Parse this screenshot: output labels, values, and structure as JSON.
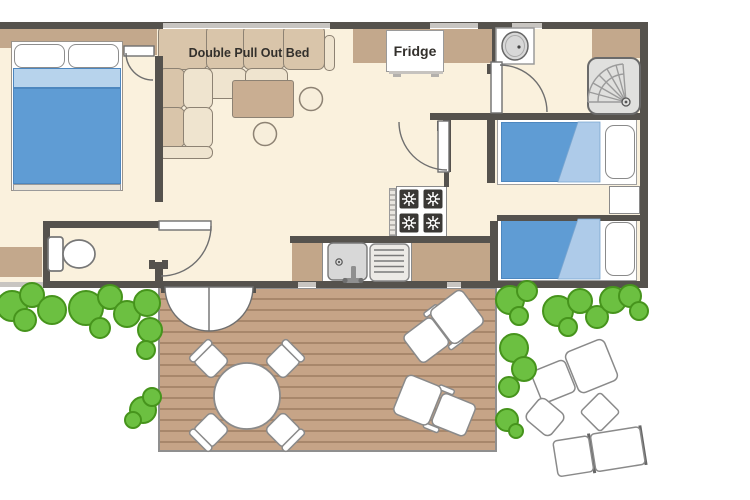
{
  "plan": {
    "labels": {
      "sofa_bed": "Double Pull Out Bed",
      "fridge": "Fridge"
    }
  },
  "colors": {
    "background": "#ffffff",
    "floor": "#faf1dd",
    "wall": "#55524d",
    "window": "#c8c5c1",
    "cabinet_tan": "#c3a88c",
    "counter_tan": "#c2a689",
    "deck_wood": "#c6a487",
    "deck_line": "#a8876b",
    "sofa_back": "#d9c5aa",
    "sofa_seat": "#efe4cf",
    "furniture_outline": "#8d8273",
    "bed_blue": "#5f9cd4",
    "bed_blue_light": "#aecbe9",
    "bed_strip": "#b7d3ec",
    "bed_blue_edge": "#4d87bf",
    "green": "#6cc041",
    "green_dark": "#46941c",
    "gray_outline": "#8a8a8a",
    "door_arc": "#6f6f6f",
    "text": "#33302c",
    "appliance_gray": "#d8d8d8",
    "shower_tray": "#e0e0de"
  }
}
